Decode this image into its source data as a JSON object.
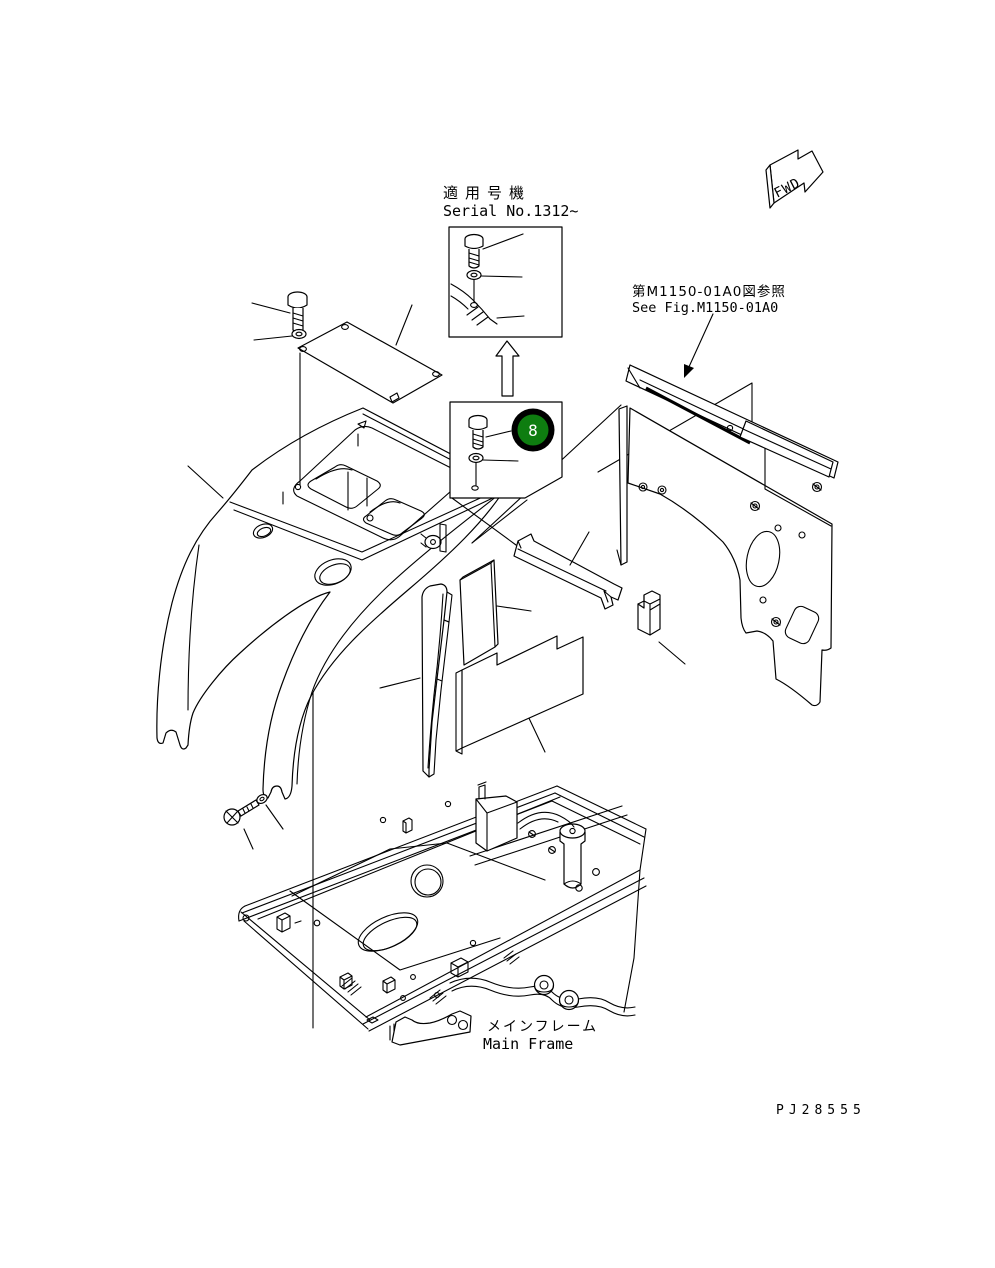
{
  "page": {
    "background": "#ffffff",
    "line_color": "#000000"
  },
  "labels": {
    "serial_jp": "適用号機",
    "serial_en": "Serial No.1312~",
    "see_fig_jp": "第M1150-01A0図参照",
    "see_fig_en": "See Fig.M1150-01A0",
    "main_frame_jp": "メインフレーム",
    "main_frame_en": "Main Frame",
    "drawing_code": "PJ28555",
    "fwd": "FWD"
  },
  "balloon": {
    "number": "8",
    "fill": "#0e7d10",
    "ring": "#000000",
    "text_color": "#ffffff"
  }
}
